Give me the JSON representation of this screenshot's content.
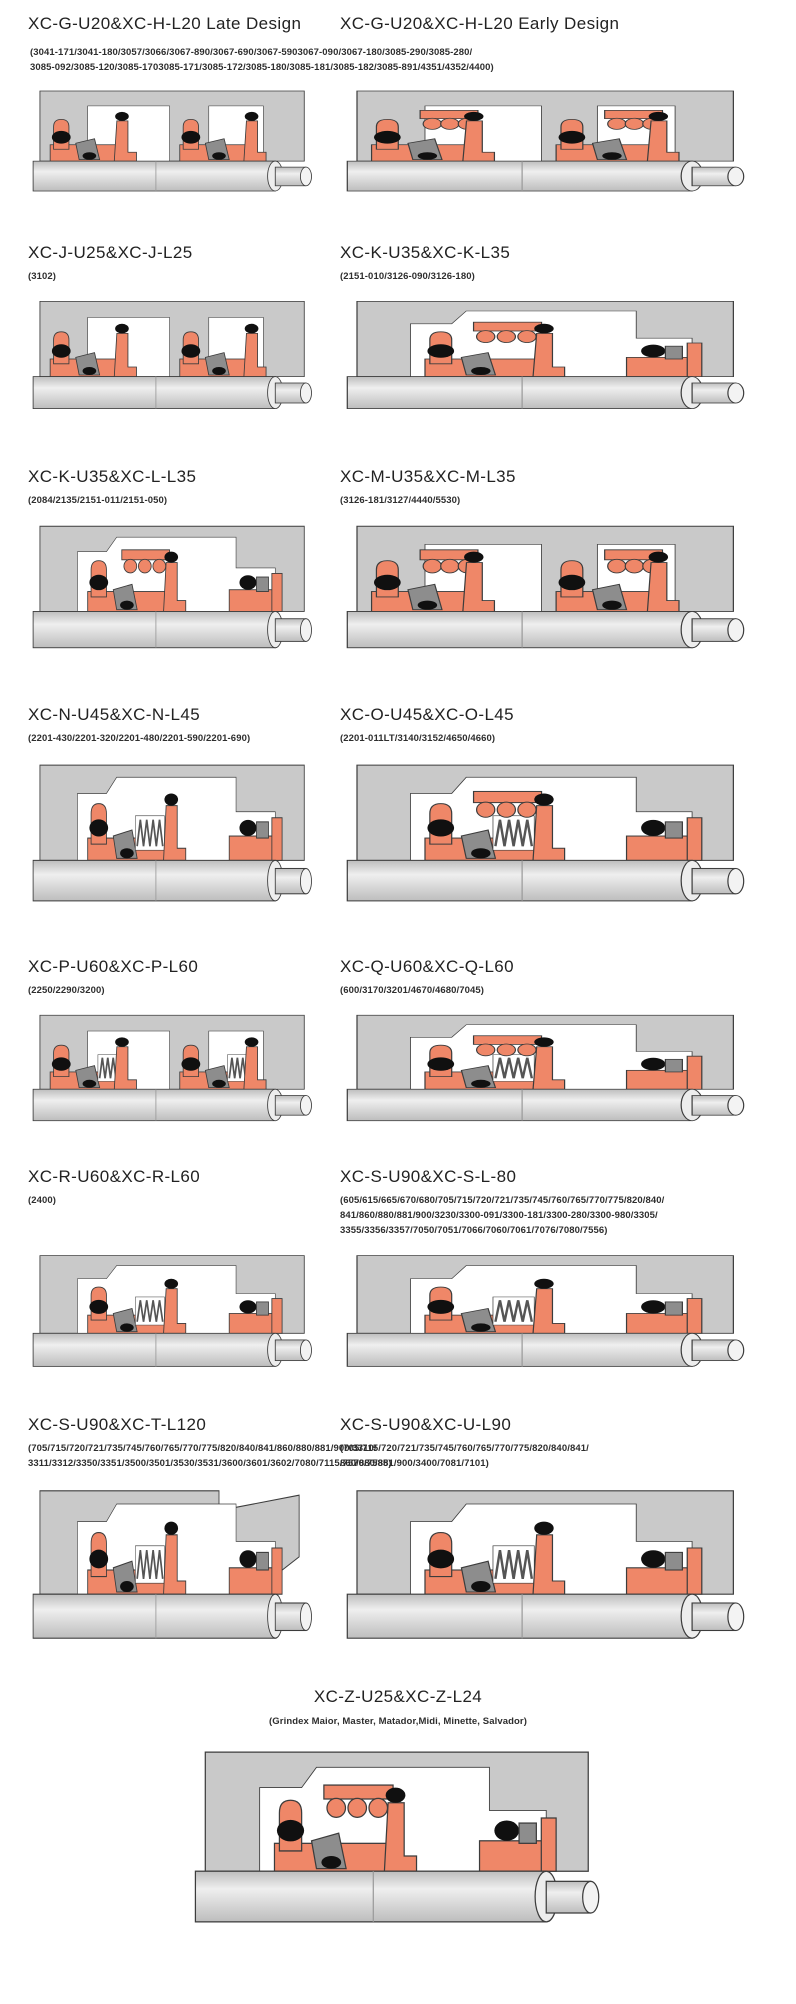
{
  "page": {
    "background": "#ffffff"
  },
  "colors": {
    "housing": "#c9c9c9",
    "seal": "#ef8768",
    "oring": "#101010",
    "part_gray": "#8d8d8d",
    "outline": "#3c3c3c",
    "shaft_light": "#efefef",
    "shaft_mid": "#bdbdbd",
    "cavity": "#ffffff"
  },
  "row1_codes": [
    "(3041-171/3041-180/3057/3066/3067-890/3067-690/3067-5903067-090/3067-180/3085-290/3085-280/",
    "3085-092/3085-120/3085-1703085-171/3085-172/3085-180/3085-181/3085-182/3085-891/4351/4352/4400)"
  ],
  "sections": [
    {
      "id": "xc-g-late",
      "title": "XC-G-U20&XC-H-L20 Late Design",
      "codes": [],
      "variant": "dual"
    },
    {
      "id": "xc-g-early",
      "title": "XC-G-U20&XC-H-L20 Early Design",
      "codes": [],
      "variant": "dual-balls"
    },
    {
      "id": "xc-j",
      "title": "XC-J-U25&XC-J-L25",
      "codes": [
        "(3102)"
      ],
      "variant": "dual"
    },
    {
      "id": "xc-k",
      "title": "XC-K-U35&XC-K-L35",
      "codes": [
        "(2151-010/3126-090/3126-180)"
      ],
      "variant": "balls"
    },
    {
      "id": "xc-kl",
      "title": "XC-K-U35&XC-L-L35",
      "codes": [
        "(2084/2135/2151-011/2151-050)"
      ],
      "variant": "balls"
    },
    {
      "id": "xc-m",
      "title": "XC-M-U35&XC-M-L35",
      "codes": [
        "(3126-181/3127/4440/5530)"
      ],
      "variant": "dual-balls"
    },
    {
      "id": "xc-n",
      "title": "XC-N-U45&XC-N-L45",
      "codes": [
        "(2201-430/2201-320/2201-480/2201-590/2201-690)"
      ],
      "variant": "coil"
    },
    {
      "id": "xc-o",
      "title": "XC-O-U45&XC-O-L45",
      "codes": [
        "(2201-011LT/3140/3152/4650/4660)"
      ],
      "variant": "coil-balls"
    },
    {
      "id": "xc-p",
      "title": "XC-P-U60&XC-P-L60",
      "codes": [
        "(2250/2290/3200)"
      ],
      "variant": "dual-coil"
    },
    {
      "id": "xc-q",
      "title": "XC-Q-U60&XC-Q-L60",
      "codes": [
        "(600/3170/3201/4670/4680/7045)"
      ],
      "variant": "coil-balls"
    },
    {
      "id": "xc-r",
      "title": "XC-R-U60&XC-R-L60",
      "codes": [
        "(2400)"
      ],
      "variant": "coil"
    },
    {
      "id": "xc-s",
      "title": "XC-S-U90&XC-S-L-80",
      "codes": [
        "(605/615/665/670/680/705/715/720/721/735/745/760/765/770/775/820/840/",
        "841/860/880/881/900/3230/3300-091/3300-181/3300-280/3300-980/3305/",
        "3355/3356/3357/7050/7051/7066/7060/7061/7076/7080/7556)"
      ],
      "variant": "coil"
    },
    {
      "id": "xc-t",
      "title": "XC-S-U90&XC-T-L120",
      "codes": [
        "(705/715/720/721/735/745/760/765/770/775/820/840/841/860/880/881/900/3310/",
        "3311/3312/3350/3351/3500/3501/3530/3531/3600/3601/3602/7080/7115/7570/7585)"
      ],
      "variant": "coil-wedge"
    },
    {
      "id": "xc-u",
      "title": "XC-S-U90&XC-U-L90",
      "codes": [
        "(705/715/720/721/735/745/760/765/770/775/820/840/841/",
        "860/880/881/900/3400/7081/7101)"
      ],
      "variant": "coil"
    },
    {
      "id": "xc-z",
      "title": "XC-Z-U25&XC-Z-L24",
      "codes": [
        "(Grindex  Maior, Master, Matador,Midi, Minette, Salvador)"
      ],
      "variant": "balls"
    }
  ]
}
